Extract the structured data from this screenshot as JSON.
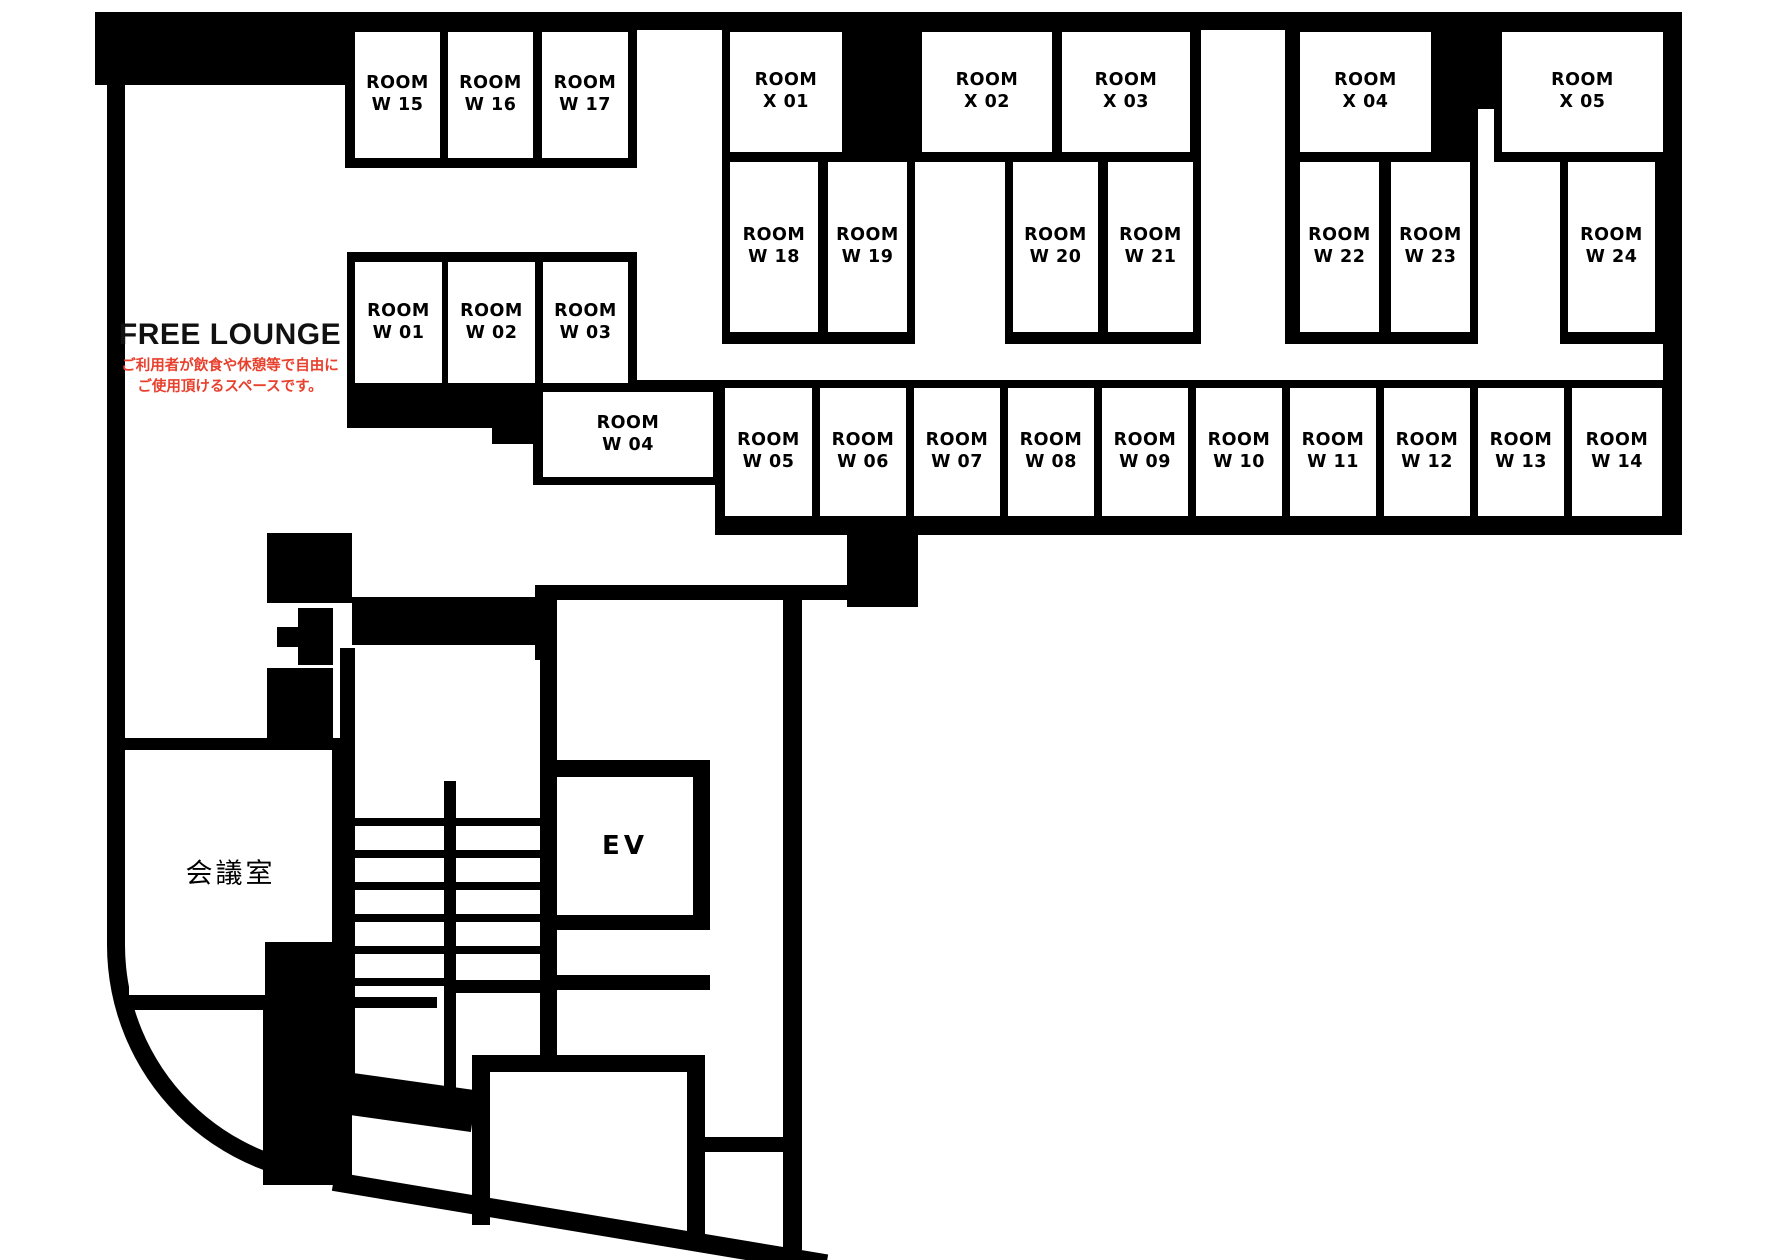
{
  "plan_title": "floor-plan",
  "colors": {
    "wall": "#000000",
    "background": "#ffffff",
    "note_red": "#e8402d"
  },
  "free_lounge": {
    "title": "FREE LOUNGE",
    "note_line1": "ご利用者が飲食や休憩等で自由に",
    "note_line2": "ご使用頂けるスペースです。"
  },
  "special_rooms": {
    "meeting": {
      "label": "会議室",
      "x": 129,
      "y": 750,
      "w": 203,
      "h": 245
    },
    "elevator": {
      "label": "EV",
      "x": 557,
      "y": 777,
      "w": 136,
      "h": 138
    }
  },
  "rooms": [
    {
      "id": "W15",
      "line1": "ROOM",
      "line2": "W 15",
      "x": 355,
      "y": 32,
      "w": 85,
      "h": 126
    },
    {
      "id": "W16",
      "line1": "ROOM",
      "line2": "W 16",
      "x": 448,
      "y": 32,
      "w": 85,
      "h": 126
    },
    {
      "id": "W17",
      "line1": "ROOM",
      "line2": "W 17",
      "x": 542,
      "y": 32,
      "w": 86,
      "h": 126
    },
    {
      "id": "X01",
      "line1": "ROOM",
      "line2": "X 01",
      "x": 730,
      "y": 32,
      "w": 112,
      "h": 120
    },
    {
      "id": "X02",
      "line1": "ROOM",
      "line2": "X 02",
      "x": 922,
      "y": 32,
      "w": 130,
      "h": 120
    },
    {
      "id": "X03",
      "line1": "ROOM",
      "line2": "X 03",
      "x": 1062,
      "y": 32,
      "w": 128,
      "h": 120
    },
    {
      "id": "X04",
      "line1": "ROOM",
      "line2": "X 04",
      "x": 1300,
      "y": 32,
      "w": 131,
      "h": 120
    },
    {
      "id": "X05",
      "line1": "ROOM",
      "line2": "X 05",
      "x": 1502,
      "y": 32,
      "w": 161,
      "h": 120
    },
    {
      "id": "W18",
      "line1": "ROOM",
      "line2": "W 18",
      "x": 730,
      "y": 162,
      "w": 88,
      "h": 170
    },
    {
      "id": "W19",
      "line1": "ROOM",
      "line2": "W 19",
      "x": 828,
      "y": 162,
      "w": 79,
      "h": 170
    },
    {
      "id": "W20",
      "line1": "ROOM",
      "line2": "W 20",
      "x": 1013,
      "y": 162,
      "w": 85,
      "h": 170
    },
    {
      "id": "W21",
      "line1": "ROOM",
      "line2": "W 21",
      "x": 1108,
      "y": 162,
      "w": 85,
      "h": 170
    },
    {
      "id": "W22",
      "line1": "ROOM",
      "line2": "W 22",
      "x": 1300,
      "y": 162,
      "w": 79,
      "h": 170
    },
    {
      "id": "W23",
      "line1": "ROOM",
      "line2": "W 23",
      "x": 1391,
      "y": 162,
      "w": 79,
      "h": 170
    },
    {
      "id": "W24",
      "line1": "ROOM",
      "line2": "W 24",
      "x": 1568,
      "y": 162,
      "w": 87,
      "h": 170
    },
    {
      "id": "W01",
      "line1": "ROOM",
      "line2": "W 01",
      "x": 355,
      "y": 262,
      "w": 87,
      "h": 121
    },
    {
      "id": "W02",
      "line1": "ROOM",
      "line2": "W 02",
      "x": 448,
      "y": 262,
      "w": 87,
      "h": 121
    },
    {
      "id": "W03",
      "line1": "ROOM",
      "line2": "W 03",
      "x": 543,
      "y": 262,
      "w": 85,
      "h": 121
    },
    {
      "id": "W04",
      "line1": "ROOM",
      "line2": "W 04",
      "x": 543,
      "y": 392,
      "w": 170,
      "h": 85
    },
    {
      "id": "W05",
      "line1": "ROOM",
      "line2": "W 05",
      "x": 725,
      "y": 388,
      "w": 87,
      "h": 128
    },
    {
      "id": "W06",
      "line1": "ROOM",
      "line2": "W 06",
      "x": 820,
      "y": 388,
      "w": 86,
      "h": 128
    },
    {
      "id": "W07",
      "line1": "ROOM",
      "line2": "W 07",
      "x": 914,
      "y": 388,
      "w": 86,
      "h": 128
    },
    {
      "id": "W08",
      "line1": "ROOM",
      "line2": "W 08",
      "x": 1008,
      "y": 388,
      "w": 86,
      "h": 128
    },
    {
      "id": "W09",
      "line1": "ROOM",
      "line2": "W 09",
      "x": 1102,
      "y": 388,
      "w": 86,
      "h": 128
    },
    {
      "id": "W10",
      "line1": "ROOM",
      "line2": "W 10",
      "x": 1196,
      "y": 388,
      "w": 86,
      "h": 128
    },
    {
      "id": "W11",
      "line1": "ROOM",
      "line2": "W 11",
      "x": 1290,
      "y": 388,
      "w": 86,
      "h": 128
    },
    {
      "id": "W12",
      "line1": "ROOM",
      "line2": "W 12",
      "x": 1384,
      "y": 388,
      "w": 86,
      "h": 128
    },
    {
      "id": "W13",
      "line1": "ROOM",
      "line2": "W 13",
      "x": 1478,
      "y": 388,
      "w": 86,
      "h": 128
    },
    {
      "id": "W14",
      "line1": "ROOM",
      "line2": "W 14",
      "x": 1572,
      "y": 388,
      "w": 90,
      "h": 128
    }
  ]
}
